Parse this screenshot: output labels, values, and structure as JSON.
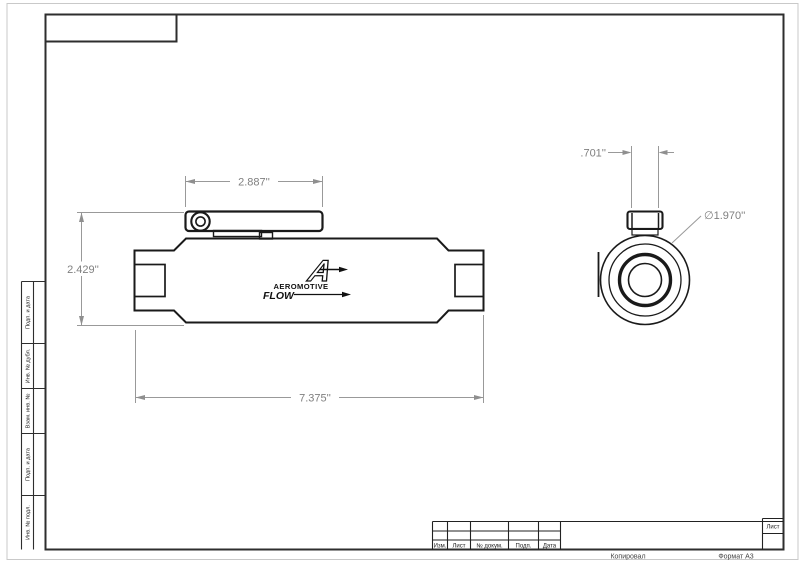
{
  "sheet": {
    "footer_left": "Копировал",
    "footer_right": "Формат А3"
  },
  "title_block": {
    "columns": [
      "Изм.",
      "Лист",
      "№ докум.",
      "Подп.",
      "Дата"
    ],
    "sheet_label": "Лист"
  },
  "margin_strip": {
    "labels": [
      "Подп. и дата",
      "Инв. № дубл.",
      "Взам. инв. №",
      "Подп. и дата",
      "Инв. № подл."
    ]
  },
  "part": {
    "logo": {
      "mark": "A",
      "brand": "AEROMOTIVE",
      "flow": "FLOW"
    },
    "dimensions": {
      "bracket_length": "2.887''",
      "overall_height": "2.429''",
      "overall_length": "7.375''",
      "port_width": ".701''",
      "body_diameter": "∅1.970''"
    }
  },
  "colors": {
    "part_line": "#1a1a1a",
    "dimension": "#8f8f8f",
    "frame": "#2e2e2e",
    "sheet_edge": "#c9c9c9"
  }
}
